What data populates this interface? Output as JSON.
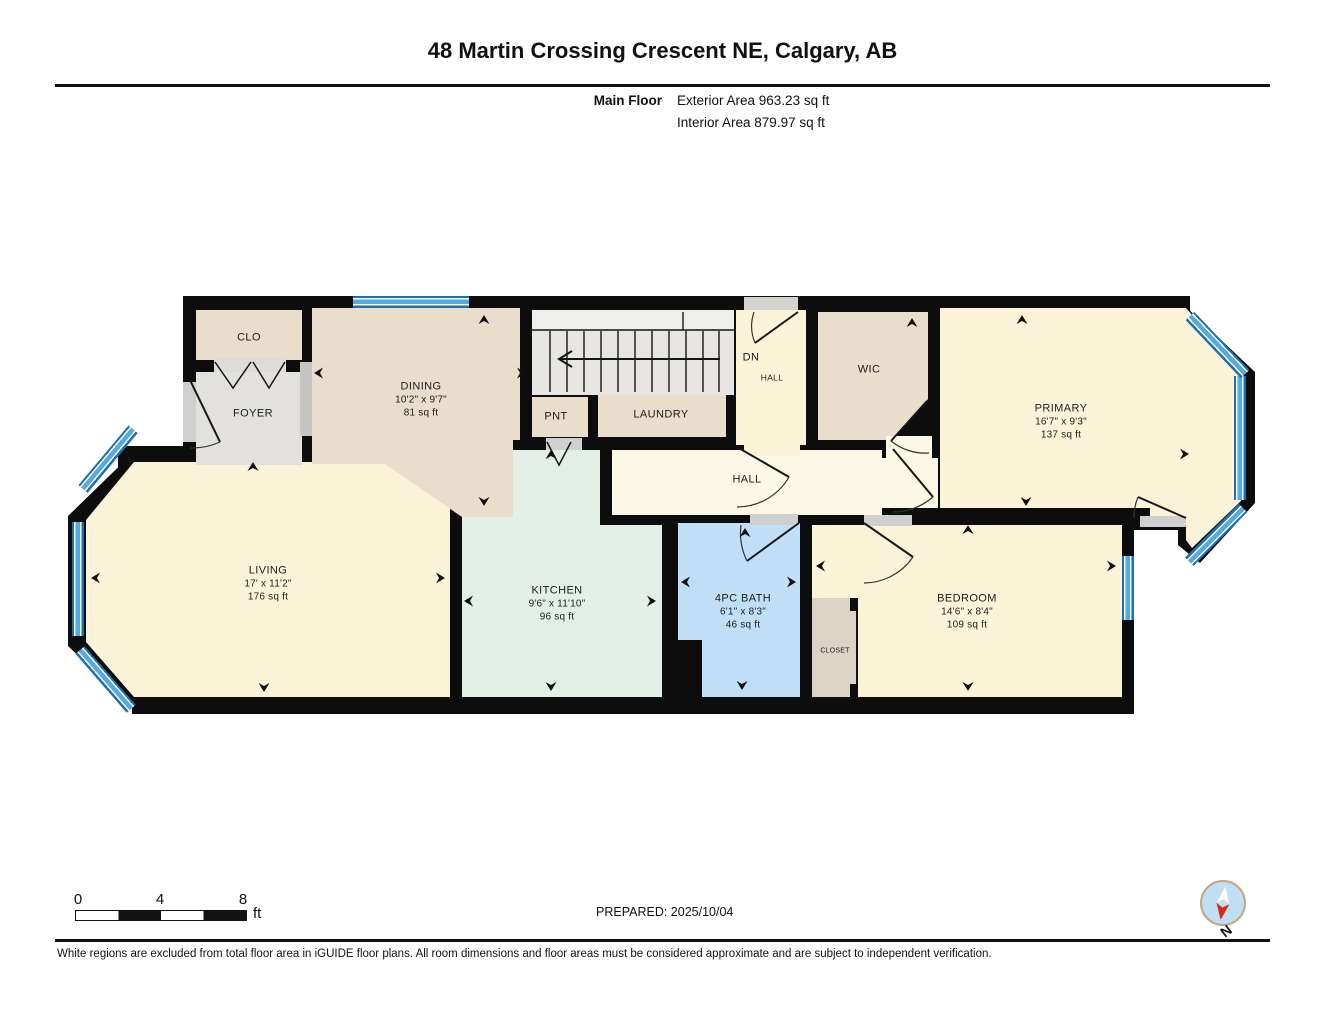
{
  "header": {
    "title": "48 Martin Crossing Crescent NE, Calgary, AB",
    "floor_label": "Main Floor",
    "exterior_area": "Exterior Area 963.23 sq ft",
    "interior_area": "Interior Area 879.97 sq ft"
  },
  "rooms": {
    "clo": {
      "name": "CLO"
    },
    "foyer": {
      "name": "FOYER"
    },
    "dining": {
      "name": "DINING",
      "dims": "10'2\" x 9'7\"",
      "area": "81 sq ft"
    },
    "pnt": {
      "name": "PNT"
    },
    "laundry": {
      "name": "LAUNDRY"
    },
    "dn": {
      "name": "DN"
    },
    "dn_hall": {
      "name": "HALL"
    },
    "wic": {
      "name": "WIC"
    },
    "primary": {
      "name": "PRIMARY",
      "dims": "16'7\" x 9'3\"",
      "area": "137 sq ft"
    },
    "hall": {
      "name": "HALL"
    },
    "living": {
      "name": "LIVING",
      "dims": "17' x 11'2\"",
      "area": "176 sq ft"
    },
    "kitchen": {
      "name": "KITCHEN",
      "dims": "9'6\" x 11'10\"",
      "area": "96 sq ft"
    },
    "bath": {
      "name": "4PC BATH",
      "dims": "6'1\" x 8'3\"",
      "area": "46 sq ft"
    },
    "closet": {
      "name": "CLOSET"
    },
    "bedroom": {
      "name": "BEDROOM",
      "dims": "14'6\" x 8'4\"",
      "area": "109 sq ft"
    }
  },
  "scale_bar": {
    "tick0": "0",
    "tick4": "4",
    "tick8": "8",
    "unit": "ft"
  },
  "prepared": "PREPARED: 2025/10/04",
  "compass": {
    "north_label": "N"
  },
  "footer": "White regions are excluded from total floor area in iGUIDE floor plans. All room dimensions and floor areas must be considered approximate and are subject to independent verification.",
  "colors": {
    "wall": "#0d0d0d",
    "cream": "#fbf3d8",
    "hall_cream": "#fcf8e6",
    "tan": "#e9decb",
    "gray_floor": "#e2e1de",
    "kitchen_mint": "#e3efe6",
    "bath_blue": "#c0dff6",
    "closet_tan": "#dbd3c5",
    "window_blue": "#58a9dc"
  }
}
